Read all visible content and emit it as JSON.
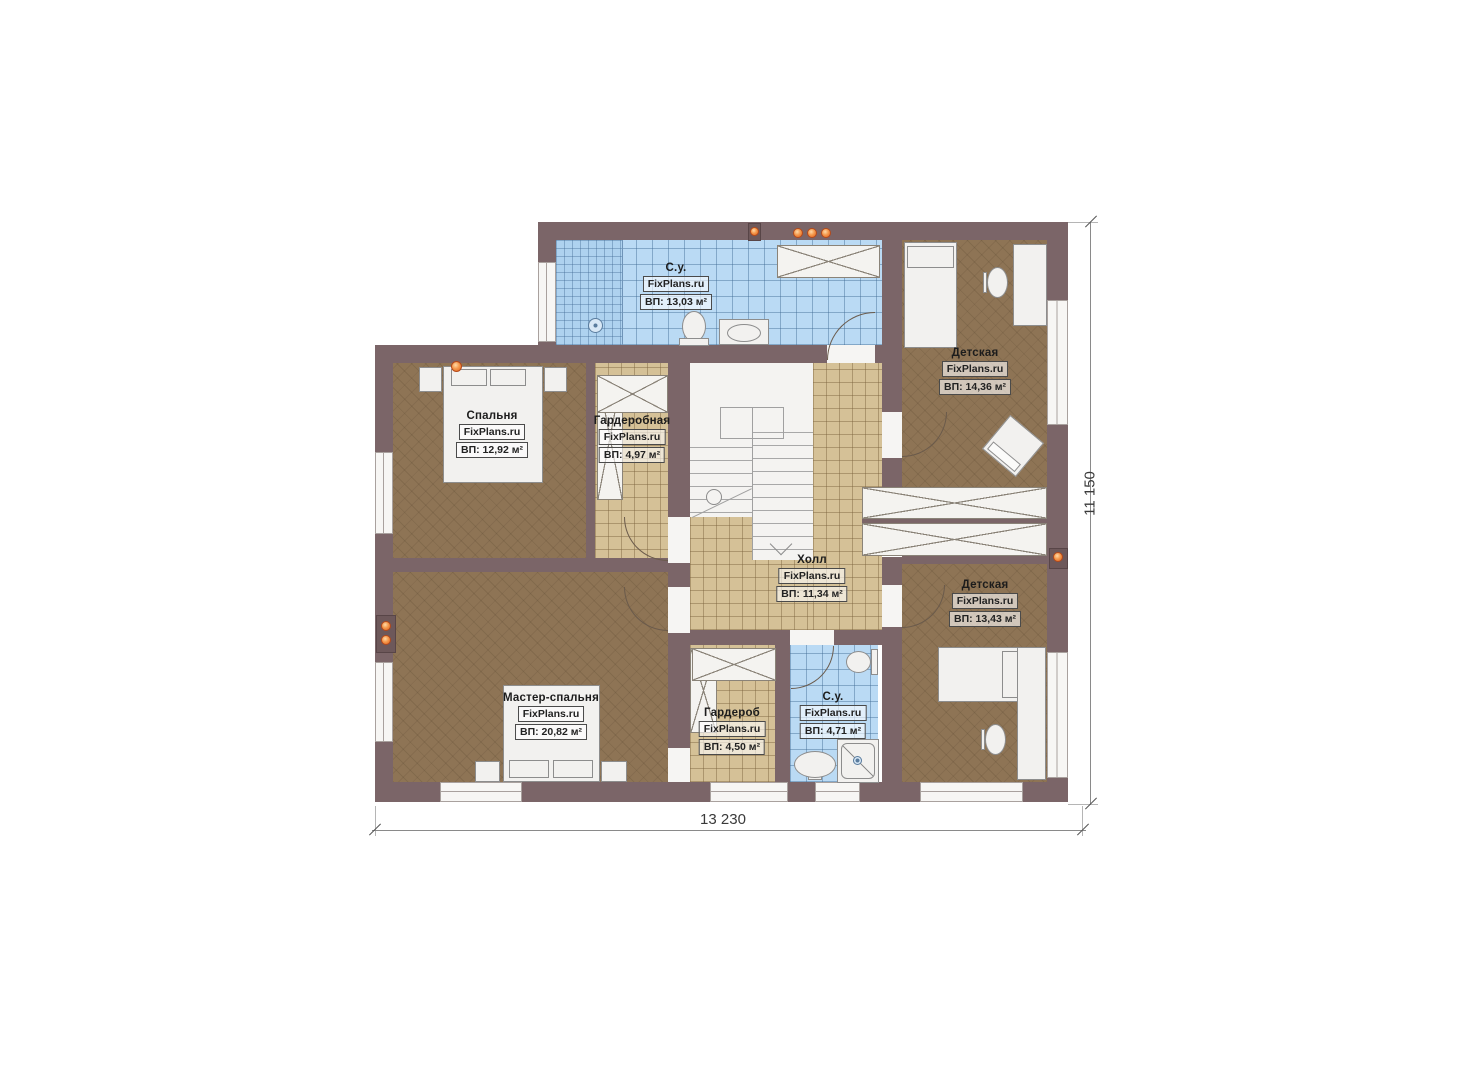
{
  "plan": {
    "title": "Floor plan — second level",
    "brand": "FixPlans.ru",
    "dimensions": {
      "width": "13 230",
      "height": "11 150"
    },
    "rooms": [
      {
        "key": "bathroom-top",
        "name": "С.у.",
        "source": "FixPlans.ru",
        "area": "ВП: 13,03 м²"
      },
      {
        "key": "nursery-top",
        "name": "Детская",
        "source": "FixPlans.ru",
        "area": "ВП: 14,36 м²"
      },
      {
        "key": "bedroom",
        "name": "Спальня",
        "source": "FixPlans.ru",
        "area": "ВП: 12,92 м²"
      },
      {
        "key": "wardrobe-room",
        "name": "Гардеробная",
        "source": "FixPlans.ru",
        "area": "ВП: 4,97 м²"
      },
      {
        "key": "hall",
        "name": "Холл",
        "source": "FixPlans.ru",
        "area": "ВП: 11,34 м²"
      },
      {
        "key": "nursery-bottom",
        "name": "Детская",
        "source": "FixPlans.ru",
        "area": "ВП: 13,43 м²"
      },
      {
        "key": "master-bedroom",
        "name": "Мастер-спальня",
        "source": "FixPlans.ru",
        "area": "ВП: 20,82 м²"
      },
      {
        "key": "wardrobe",
        "name": "Гардероб",
        "source": "FixPlans.ru",
        "area": "ВП: 4,50 м²"
      },
      {
        "key": "bathroom-bottom",
        "name": "С.у.",
        "source": "FixPlans.ru",
        "area": "ВП: 4,71 м²"
      }
    ],
    "colors": {
      "wall": "#7b6568",
      "floor_wood": "#8e7455",
      "floor_tile": "#d5c197",
      "floor_bath": "#badaf4",
      "vent_accent": "#e8732a"
    }
  }
}
